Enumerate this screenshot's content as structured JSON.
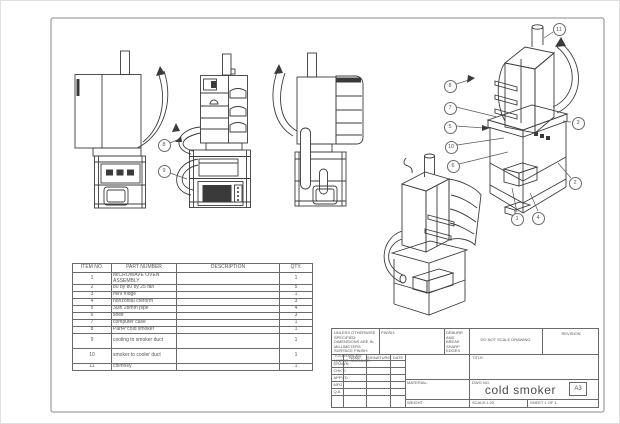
{
  "palette": {
    "line": "#3c3c3c",
    "text": "#555555",
    "sheet_border": "#8a8a8a"
  },
  "bom": {
    "headers": [
      "ITEM NO.",
      "PART NUMBER",
      "DESCRIPTION",
      "QTY."
    ],
    "rows": [
      {
        "item": "1",
        "part": "MICROWAVE OVEN ASSEMBLY",
        "desc": "",
        "qty": "1"
      },
      {
        "item": "2",
        "part": "80 by 80 by 25 fan",
        "desc": "",
        "qty": "5"
      },
      {
        "item": "3",
        "part": "mini fridge",
        "desc": "",
        "qty": "1"
      },
      {
        "item": "4",
        "part": "horizontal creform",
        "desc": "",
        "qty": "3"
      },
      {
        "item": "5",
        "part": "30in 28mm pipe",
        "desc": "",
        "qty": "4"
      },
      {
        "item": "6",
        "part": "shelf",
        "desc": "",
        "qty": "3"
      },
      {
        "item": "7",
        "part": "computer case",
        "desc": "",
        "qty": "1"
      },
      {
        "item": "8",
        "part": "Part4^cold smoker",
        "desc": "",
        "qty": "1"
      },
      {
        "item": "9",
        "part": "cooling to smoker duct",
        "desc": "",
        "qty": "1"
      },
      {
        "item": "10",
        "part": "smoker to cooler duct",
        "desc": "",
        "qty": "1"
      },
      {
        "item": "11",
        "part": "chimney",
        "desc": "",
        "qty": "1"
      }
    ]
  },
  "title_block": {
    "tolerance_lines": "UNLESS OTHERWISE SPECIFIED: DIMENSIONS ARE IN MILLIMETERS SURFACE FINISH: TOLERANCES: LINEAR: ANGULAR:",
    "finish_label": "FINISH:",
    "deburr_label": "DEBURR AND BREAK SHARP EDGES",
    "do_not_scale": "DO NOT SCALE DRAWING",
    "revision_label": "REVISION",
    "sign_headers": {
      "name": "NAME",
      "signature": "SIGNATURE",
      "date": "DATE"
    },
    "sign_rows": {
      "r0": "DRAWN",
      "r1": "CHK'D",
      "r2": "APPV'D",
      "r3": "MFG",
      "r4": "Q.A"
    },
    "material_label": "MATERIAL:",
    "weight_label": "WEIGHT:",
    "title_label": "TITLE:",
    "dwg_label": "DWG NO.",
    "title": "cold smoker",
    "paper_size": "A3",
    "scale_label": "SCALE:1:20",
    "sheet_label": "SHEET 1 OF 1"
  },
  "balloons": {
    "v1": [
      "8",
      "9"
    ],
    "iso": [
      "11",
      "8",
      "7",
      "5",
      "10",
      "6",
      "3",
      "2",
      "1",
      "4"
    ]
  }
}
